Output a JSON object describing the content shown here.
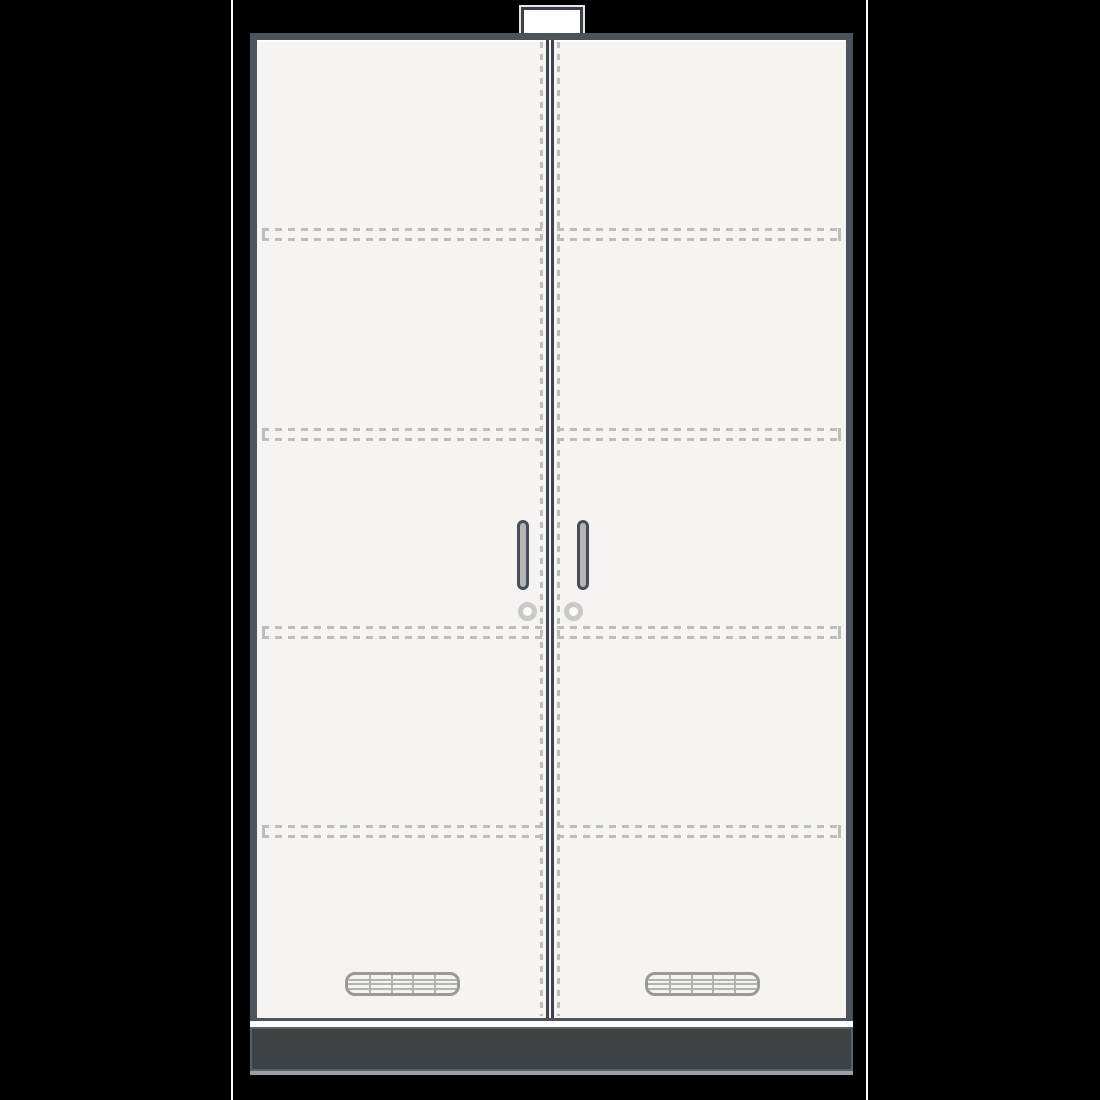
{
  "figure": {
    "type": "technical-illustration",
    "subject": "double-door-cabinet-front-view",
    "visible_text": ""
  },
  "colors": {
    "background": "#000000",
    "margin_rule": "#ffffff",
    "frame": "#4d535c",
    "door_fill": "#f5f4f1",
    "seam_line": "#3d434c",
    "dashed_line": "#bdbdbd",
    "base_fill": "#3f4245",
    "base_trim": "#9ba0a6",
    "handle_outline": "#474e58",
    "handle_fill": "#b5b5b5",
    "lock_ring": "#c9c9c9",
    "vent_border": "#9a9a9a",
    "vent_grid": "#b2b2b2",
    "top_cap_fill": "#ffffff",
    "top_cap_border": "#394048",
    "top_cap_plinth": "#3a3f46"
  },
  "components": {
    "doors": [
      {
        "id": "left-door"
      },
      {
        "id": "right-door"
      }
    ],
    "shelf_lines": [
      {
        "y_top": 228,
        "y_bottom": 238
      },
      {
        "y_top": 428,
        "y_bottom": 438
      },
      {
        "y_top": 626,
        "y_bottom": 636
      },
      {
        "y_top": 825,
        "y_bottom": 835
      }
    ],
    "shelf_segments": {
      "left": {
        "x": 262,
        "width": 283,
        "tick_x": 262
      },
      "right": {
        "x": 557,
        "width": 283,
        "tick_x": 838
      }
    },
    "handles_count": 2,
    "locks_count": 2,
    "vents": [
      {
        "door": "left",
        "columns": 5,
        "rows": 4
      },
      {
        "door": "right",
        "columns": 5,
        "rows": 4
      }
    ]
  }
}
